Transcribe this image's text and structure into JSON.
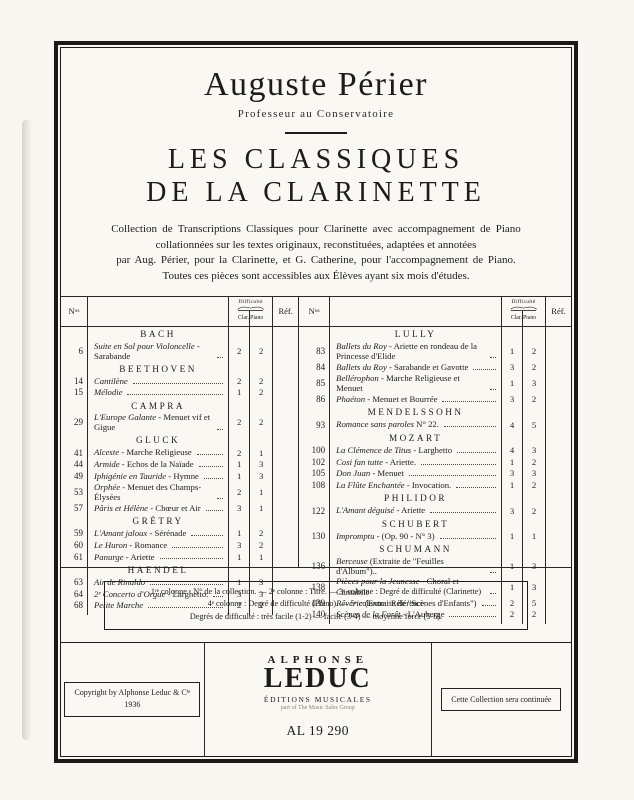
{
  "header": {
    "artist": "Auguste Périer",
    "artist_subtitle": "Professeur au Conservatoire",
    "title_line1": "LES CLASSIQUES",
    "title_line2": "DE LA CLARINETTE"
  },
  "description": {
    "lines": [
      "Collection de Transcriptions Classiques pour Clarinette avec accompagnement de Piano",
      "collationnées sur les textes originaux, reconstituées, adaptées et annotées",
      "par Aug. Périer, pour la Clarinette, et G. Catherine, pour l'accompagnement de Piano.",
      "Toutes ces pièces sont accessibles aux Élèves ayant six mois d'études."
    ]
  },
  "table": {
    "headers": {
      "no": "N",
      "no_sup": "os",
      "difficulty": "Difficulté",
      "clar": "Clar.",
      "piano": "Piano",
      "ref": "Réf."
    },
    "left_groups": [
      {
        "composer": "BACH",
        "rows": [
          {
            "no": "6",
            "ti": "Suite en Sol pour Violoncelle",
            "tr": " - Sarabande",
            "clar": "2",
            "piano": "2"
          }
        ]
      },
      {
        "composer": "BEETHOVEN",
        "rows": [
          {
            "no": "14",
            "ti": "Cantilène",
            "tr": "",
            "clar": "2",
            "piano": "2"
          },
          {
            "no": "15",
            "ti": "Mélodie",
            "tr": "",
            "clar": "1",
            "piano": "2"
          }
        ]
      },
      {
        "composer": "CAMPRA",
        "rows": [
          {
            "no": "29",
            "ti": "L'Europe Galante",
            "tr": " - Menuet vif et Gigue",
            "clar": "2",
            "piano": "2"
          }
        ]
      },
      {
        "composer": "GLUCK",
        "rows": [
          {
            "no": "41",
            "ti": "Alceste",
            "tr": " - Marche Religieuse",
            "clar": "2",
            "piano": "1"
          },
          {
            "no": "44",
            "ti": "Armide",
            "tr": " - Echos de la Naïade",
            "clar": "1",
            "piano": "3"
          },
          {
            "no": "49",
            "ti": "Iphigénie en Tauride",
            "tr": " - Hymne",
            "clar": "1",
            "piano": "3"
          },
          {
            "no": "53",
            "ti": "Orphée",
            "tr": " - Menuet des Champs-Élysées",
            "clar": "2",
            "piano": "1"
          },
          {
            "no": "57",
            "ti": "Pâris et Hélène",
            "tr": " - Chœur et Air",
            "clar": "3",
            "piano": "1"
          }
        ]
      },
      {
        "composer": "GRÉTRY",
        "rows": [
          {
            "no": "59",
            "ti": "L'Amant jaloux",
            "tr": " - Sérénade",
            "clar": "1",
            "piano": "2"
          },
          {
            "no": "60",
            "ti": "Le Huron",
            "tr": " - Romance",
            "clar": "3",
            "piano": "2"
          },
          {
            "no": "61",
            "ti": "Panurge",
            "tr": " - Ariette",
            "clar": "1",
            "piano": "1"
          }
        ]
      },
      {
        "composer": "HAENDEL",
        "rows": [
          {
            "no": "63",
            "ti": "Air de Rinaldo",
            "tr": "",
            "clar": "1",
            "piano": "3"
          },
          {
            "no": "64",
            "ti": "2ᵉ Concerto d'Orgue",
            "tr": " - Larghetto.",
            "clar": "3",
            "piano": "3"
          },
          {
            "no": "68",
            "ti": "Petite Marche",
            "tr": "",
            "clar": "2",
            "piano": "2"
          }
        ]
      }
    ],
    "right_groups": [
      {
        "composer": "LULLY",
        "rows": [
          {
            "no": "83",
            "ti": "Ballets du Roy",
            "tr": " - Ariette en rondeau de la Princesse d'Elide",
            "clar": "1",
            "piano": "2"
          },
          {
            "no": "84",
            "ti": "Ballets du Roy",
            "tr": " - Sarabande et Gavotte",
            "clar": "3",
            "piano": "2"
          },
          {
            "no": "85",
            "ti": "Bellérophon",
            "tr": " - Marche Religieuse et Menuet",
            "clar": "1",
            "piano": "3"
          },
          {
            "no": "86",
            "ti": "Phaéton",
            "tr": " - Menuet et Bourrée",
            "clar": "3",
            "piano": "2"
          }
        ]
      },
      {
        "composer": "MENDELSSOHN",
        "rows": [
          {
            "no": "93",
            "ti": "Romance sans paroles",
            "tr": " N° 22.",
            "clar": "4",
            "piano": "5"
          }
        ]
      },
      {
        "composer": "MOZART",
        "rows": [
          {
            "no": "100",
            "ti": "La Clémence de Titus",
            "tr": " - Larghetto",
            "clar": "4",
            "piano": "3"
          },
          {
            "no": "102",
            "ti": "Cosi fan tutte",
            "tr": " - Ariette.",
            "clar": "1",
            "piano": "2"
          },
          {
            "no": "105",
            "ti": "Don Juan",
            "tr": " - Menuet",
            "clar": "3",
            "piano": "3"
          },
          {
            "no": "108",
            "ti": "La Flûte Enchantée",
            "tr": " - Invocation.",
            "clar": "1",
            "piano": "2"
          }
        ]
      },
      {
        "composer": "PHILIDOR",
        "rows": [
          {
            "no": "122",
            "ti": "L'Amant déguisé",
            "tr": " - Ariette",
            "clar": "3",
            "piano": "2"
          }
        ]
      },
      {
        "composer": "SCHUBERT",
        "rows": [
          {
            "no": "130",
            "ti": "Impromptu",
            "tr": " - (Op. 90 - N° 3)",
            "clar": "1",
            "piano": "1"
          }
        ]
      },
      {
        "composer": "SCHUMANN",
        "rows": [
          {
            "no": "136",
            "ti": "Berceuse",
            "tr": " (Extraite de \"Feuilles d'Album\")..",
            "clar": "1",
            "piano": "3"
          },
          {
            "no": "138",
            "ti": "Pièces pour la Jeunesse",
            "tr": " - Choral et Cantabile",
            "clar": "1",
            "piano": "3"
          },
          {
            "no": "139",
            "ti": "Rêverie",
            "tr": " (Extraite de \"Scènes d'Enfants\")",
            "clar": "2",
            "piano": "5"
          },
          {
            "no": "140",
            "ti": "Scènes de la Forêt",
            "tr": " - L'Auberge",
            "clar": "2",
            "piano": "2"
          }
        ]
      }
    ]
  },
  "footnote": {
    "line1": "1ʳᵉ colonne : N° de la collection. — 2ᵉ colonne : Titre. — 3ᵉ colonne : Degré de difficulté (Clarinette)",
    "line2": "4ᵉ colonne : Degré de difficulté (Piano). — 5ᵉ colonne : Référence",
    "line3": "Degrés de difficulté : très facile (1-2) — facile (3-4) — moyenne force (5-6)."
  },
  "footer": {
    "copyright_line1": "Copyright by Alphonse Leduc & Cⁱᵉ",
    "copyright_line2": "1936",
    "publisher_top": "ALPHONSE",
    "publisher_main": "LEDUC",
    "publisher_sub1": "ÉDITIONS MUSICALES",
    "publisher_sub2": "part of The Music Sales Group",
    "plate_number": "AL 19 290",
    "collection_note": "Cette Collection sera continuée"
  },
  "colors": {
    "ink": "#1d1c1a",
    "paper": "#f9f7f1"
  }
}
